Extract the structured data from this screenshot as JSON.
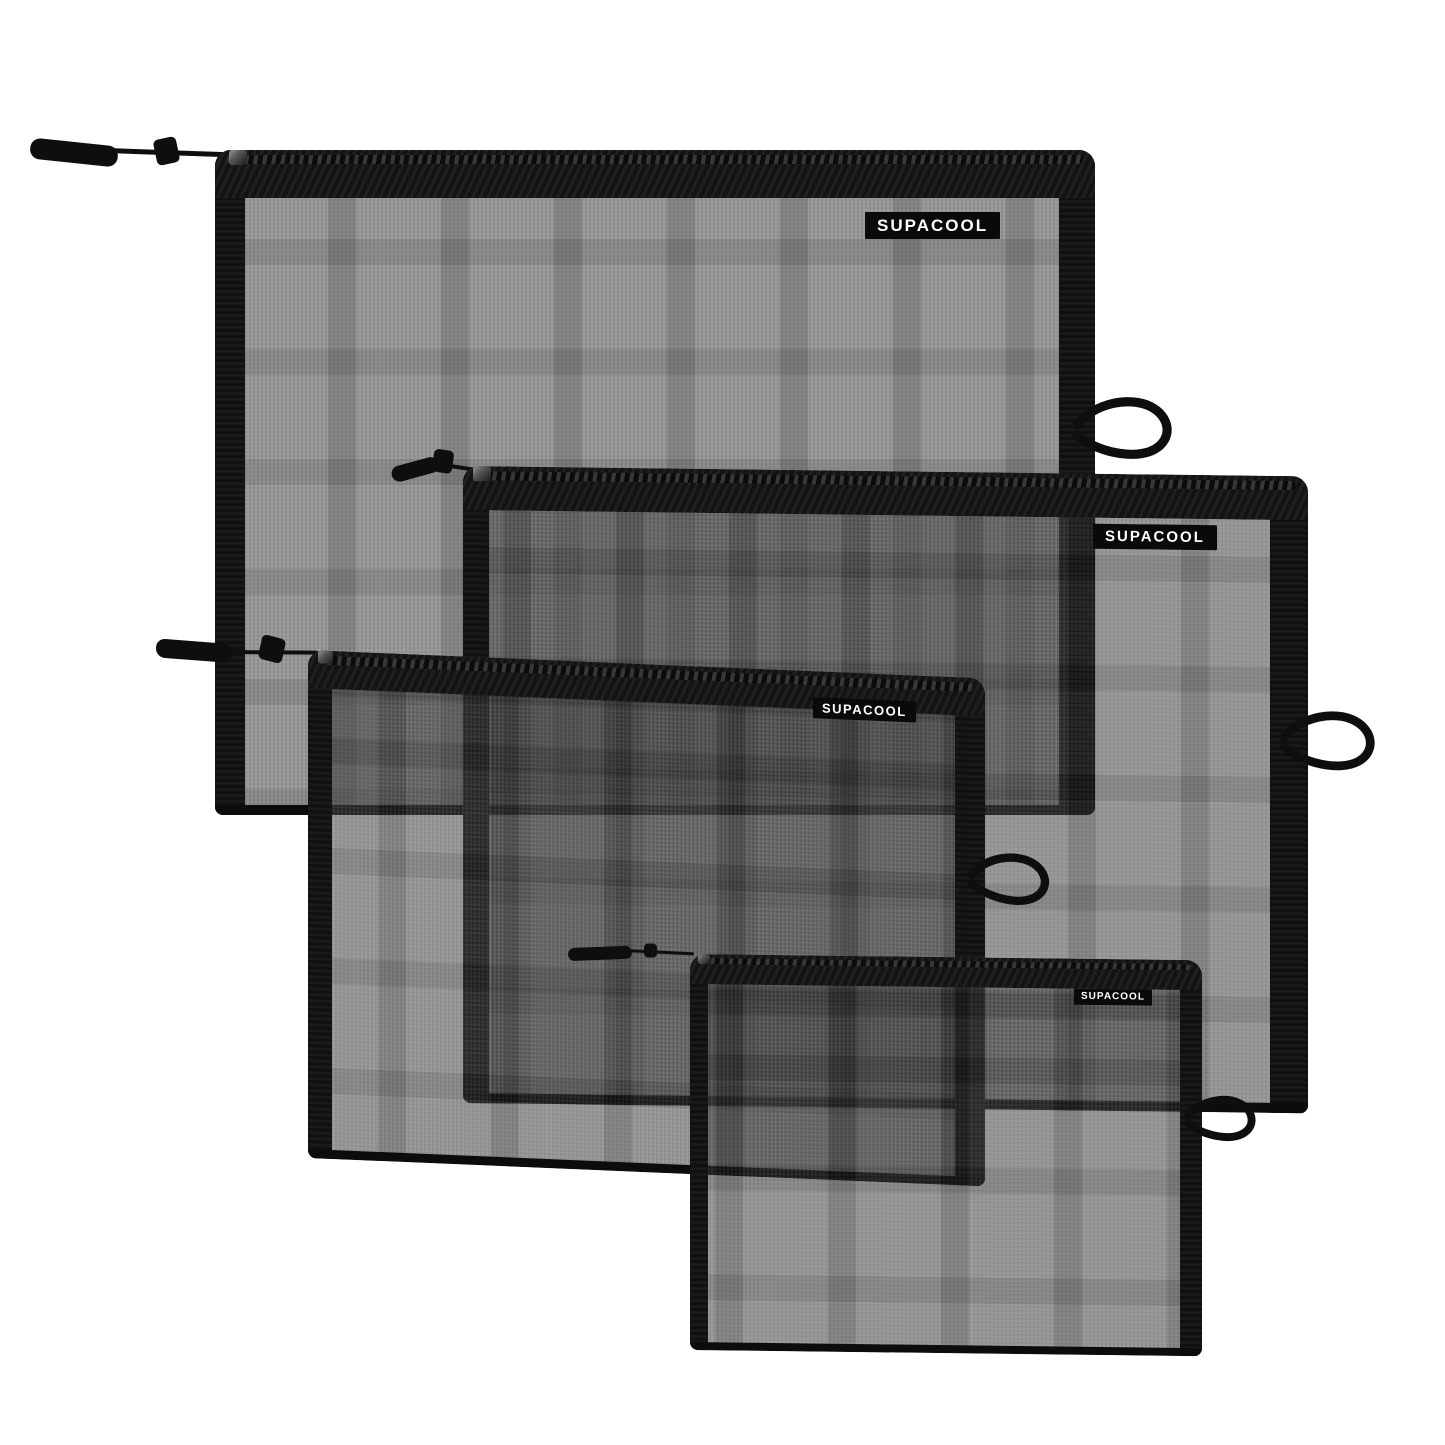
{
  "scene": {
    "type": "product-photo",
    "background_color": "#ffffff",
    "item_count": 4
  },
  "bags": [
    {
      "name": "extra-large",
      "label": "SUPACOOL"
    },
    {
      "name": "large",
      "label": "SUPACOOL"
    },
    {
      "name": "medium",
      "label": "SUPACOOL"
    },
    {
      "name": "small",
      "label": "SUPACOOL"
    }
  ],
  "colors": {
    "mesh_gray": "#8d8d8d",
    "overlap_gray": "#565656",
    "trim_black": "#131313",
    "tag_bg": "#0a0a0a",
    "tag_text": "#ffffff",
    "background": "#ffffff"
  }
}
